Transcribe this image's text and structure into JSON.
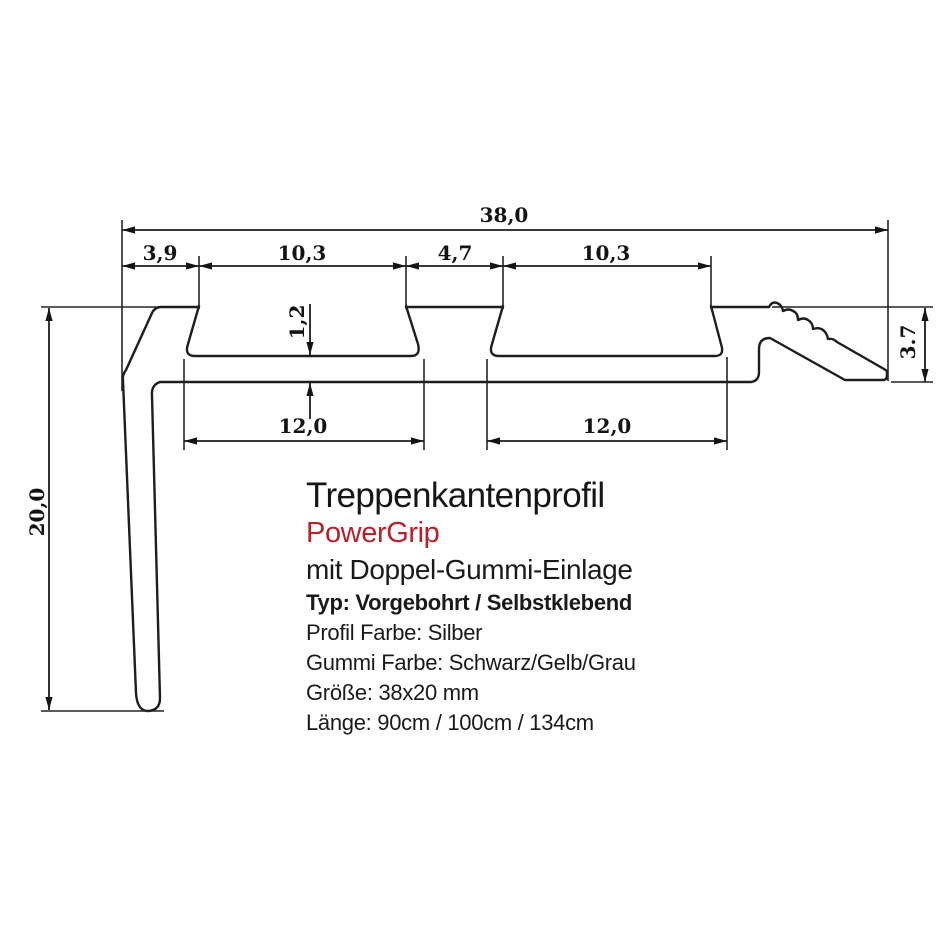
{
  "product": {
    "title": "Treppenkantenprofil",
    "brand": "PowerGrip",
    "brand_color": "#b5222b",
    "subtitle": "mit Doppel-Gummi-Einlage",
    "type_line": "Typ: Vorgebohrt / Selbstklebend",
    "profile_color_line": "Profil Farbe: Silber",
    "rubber_color_line": "Gummi Farbe: Schwarz/Gelb/Grau",
    "size_line": "Größe: 38x20 mm",
    "length_line": "Länge: 90cm / 100cm / 134cm"
  },
  "dimensions": {
    "total_width": "38,0",
    "left_offset": "3,9",
    "groove1_top_width": "10,3",
    "center_rib_width": "4,7",
    "groove2_top_width": "10,3",
    "groove1_bottom_width": "12,0",
    "groove2_bottom_width": "12,0",
    "base_thickness": "1,2",
    "leg_height": "20,0",
    "nose_height": "3.7"
  },
  "drawing": {
    "line_color": "#1d1d1d",
    "background": "#ffffff"
  }
}
